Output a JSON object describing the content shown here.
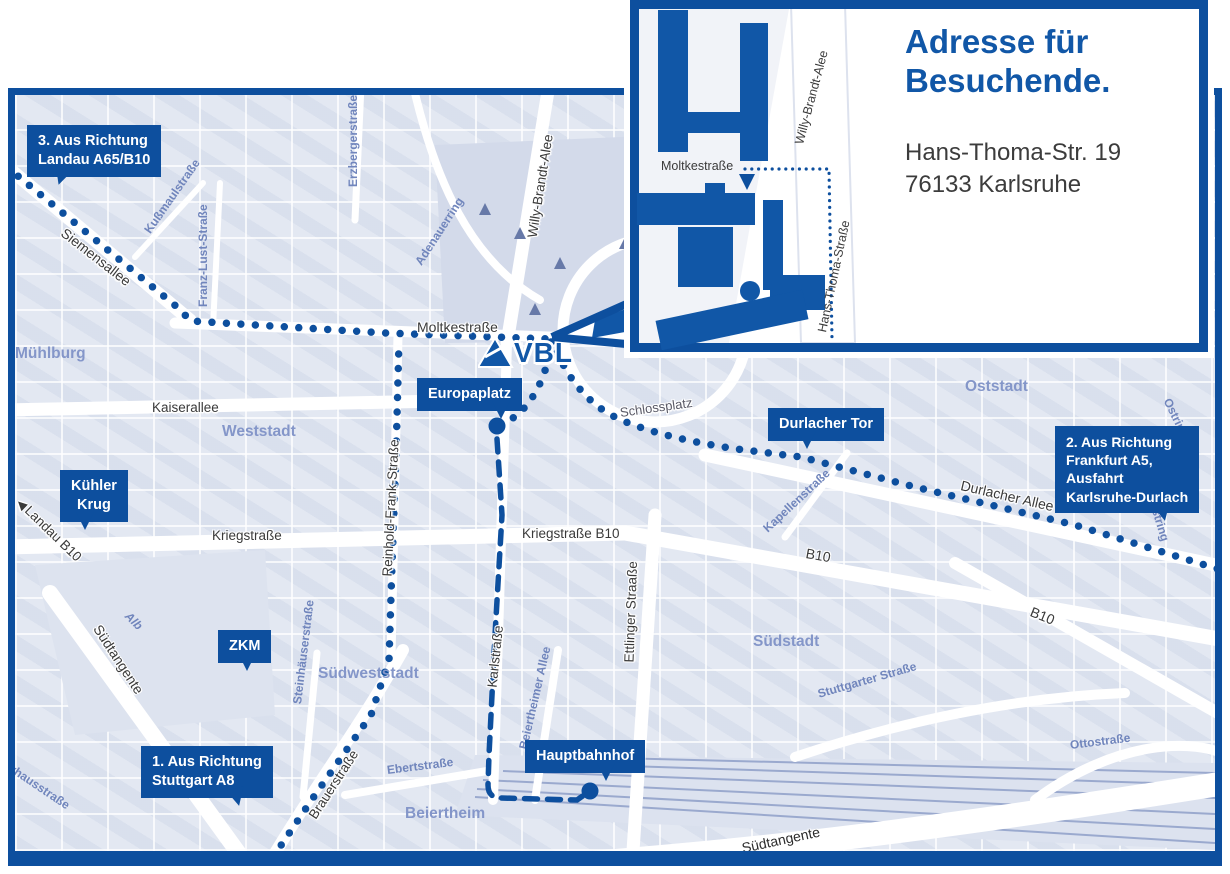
{
  "inset": {
    "title": "Adresse für\nBesuchende.",
    "address": "Hans-Thoma-Str. 19\n76133 Karlsruhe",
    "streets": {
      "moltkestrasse": "Moltkestraße",
      "willy_brandt": "Willy-Brandt-Alee",
      "hans_thoma": "Hans-Thoma-Straße"
    }
  },
  "logo": {
    "text": "VBL"
  },
  "icons": {
    "landau_arrow": "◀"
  },
  "badges": [
    {
      "id": "landau",
      "text": "3. Aus Richtung\nLandau A65/B10"
    },
    {
      "id": "kuehler-krug",
      "text": "Kühler\nKrug"
    },
    {
      "id": "zkm",
      "text": "ZKM"
    },
    {
      "id": "stuttgart",
      "text": "1. Aus Richtung\nStuttgart A8"
    },
    {
      "id": "europaplatz",
      "text": "Europaplatz"
    },
    {
      "id": "durlacher-tor",
      "text": "Durlacher Tor"
    },
    {
      "id": "frankfurt",
      "text": "2. Aus Richtung\nFrankfurt A5,\nAusfahrt\nKarlsruhe-Durlach"
    },
    {
      "id": "hauptbahnhof",
      "text": "Hauptbahnhof"
    }
  ],
  "streets": [
    {
      "label": "Siemensallee"
    },
    {
      "label": "Kußmaulstraße"
    },
    {
      "label": "Franz-Lust-Straße"
    },
    {
      "label": "Erzbergerstraße"
    },
    {
      "label": "Adenauerring"
    },
    {
      "label": "Willy-Brandt-Alee"
    },
    {
      "label": "Moltkestraße"
    },
    {
      "label": "Kaiserallee"
    },
    {
      "label": "Reinhold-Frank-Straße"
    },
    {
      "label": "Kriegstraße"
    },
    {
      "label": "Kriegstraße B10"
    },
    {
      "label": "Karlstraße"
    },
    {
      "label": "Ettlinger Straaße"
    },
    {
      "label": "Schlossplatz"
    },
    {
      "label": "Kapellenstraße"
    },
    {
      "label": "Durlacher Allee"
    },
    {
      "label": "B10"
    },
    {
      "label": "Ostring"
    },
    {
      "label": "Ostring"
    },
    {
      "label": "B10"
    },
    {
      "label": "Stuttgarter Straße"
    },
    {
      "label": "Ottostraße"
    },
    {
      "label": "Südtangente"
    },
    {
      "label": "Südtangente"
    },
    {
      "label": "Alb"
    },
    {
      "label": "Steinhäuserstraße"
    },
    {
      "label": "Brauerstraße"
    },
    {
      "label": "Ebertstraße"
    },
    {
      "label": "Beiertheimer Allee"
    },
    {
      "label": "Pulverhausstraße"
    },
    {
      "label": "Landau B10"
    }
  ],
  "areas": [
    {
      "label": "Mühlburg"
    },
    {
      "label": "Weststadt"
    },
    {
      "label": "Oststadt"
    },
    {
      "label": "Südstadt"
    },
    {
      "label": "Südweststadt"
    },
    {
      "label": "Beiertheim"
    }
  ],
  "colors": {
    "primary_blue": "#0d4f9e",
    "logo_blue": "#1157a7",
    "street_gray": "#3a3a3a",
    "street_blue": "#7085bc",
    "area_blue": "#8496c9",
    "map_background": "#e7ebf4"
  }
}
